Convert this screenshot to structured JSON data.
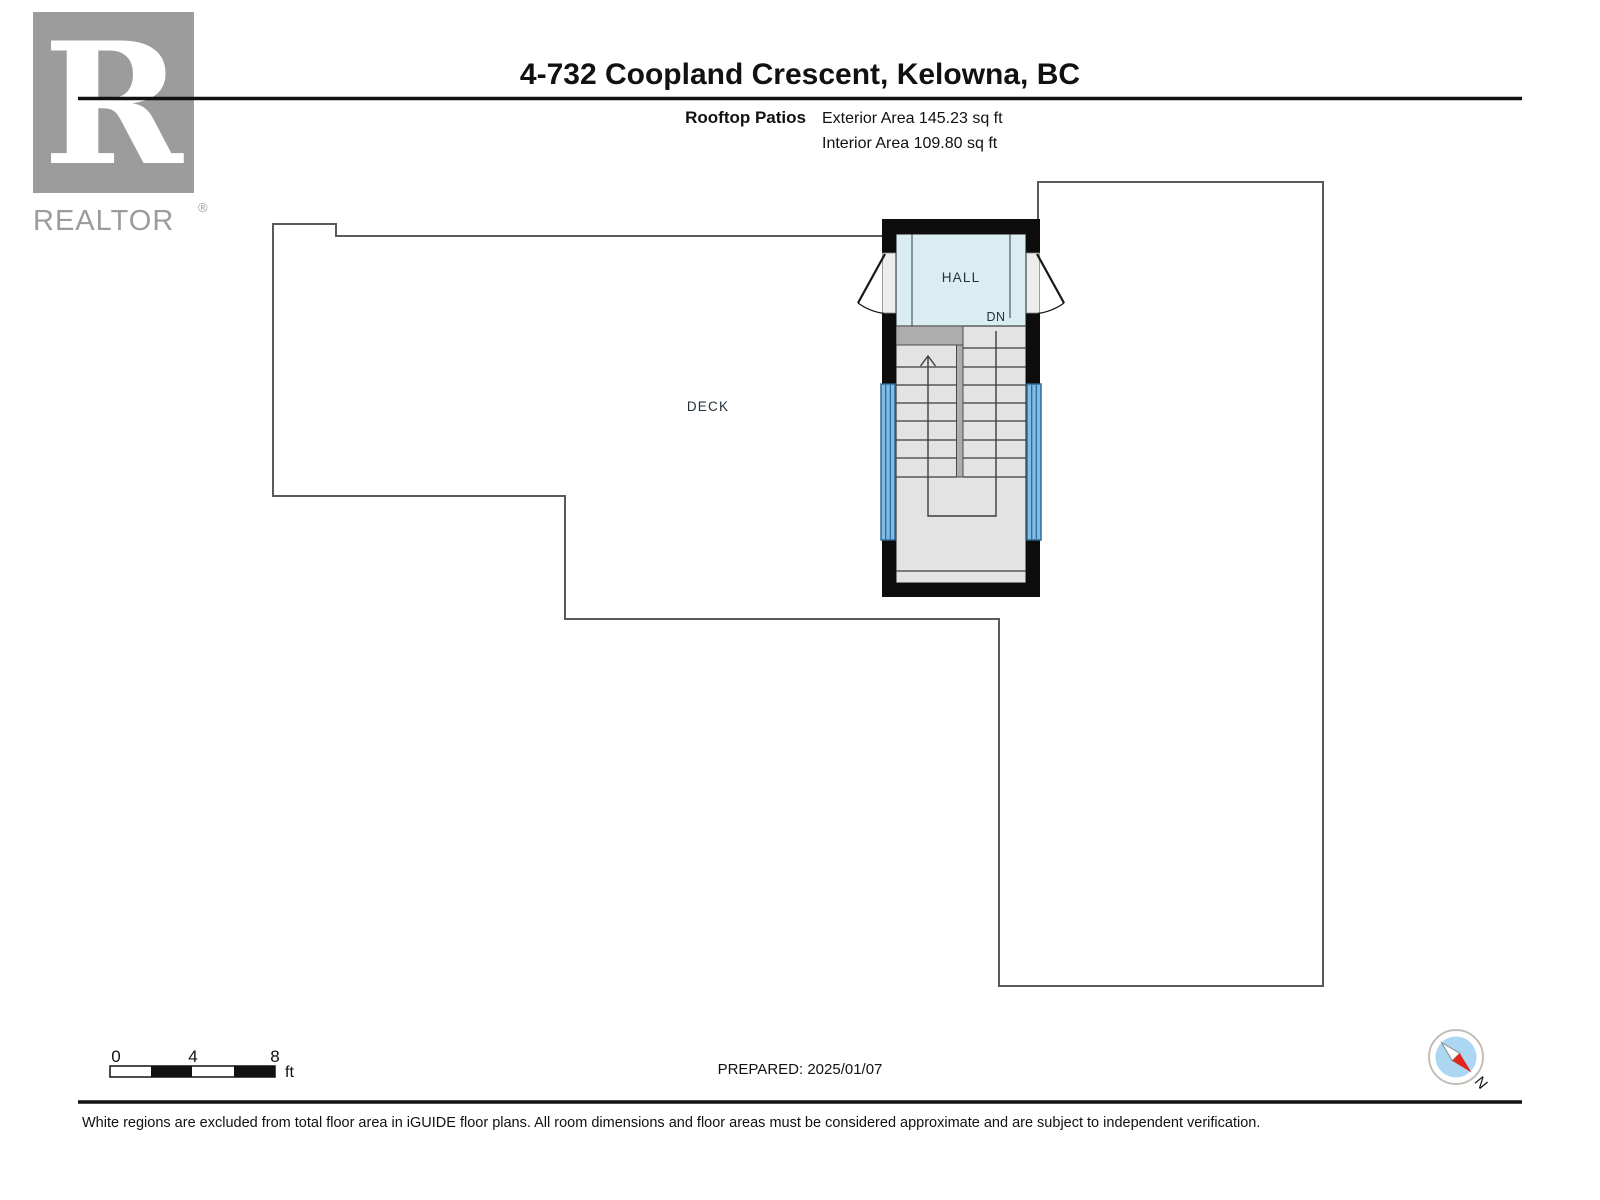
{
  "header": {
    "logo": {
      "letter": "R",
      "brand": "REALTOR",
      "registered": "®"
    },
    "title": "4-732 Coopland Crescent, Kelowna, BC",
    "floor_label": "Rooftop Patios",
    "exterior_area": "Exterior Area 145.23 sq ft",
    "interior_area": "Interior Area 109.80 sq ft"
  },
  "floorplan": {
    "deck_label": "DECK",
    "hall_label": "HALL",
    "stair_direction": "DN"
  },
  "footer": {
    "scale_bar": {
      "tick0": "0",
      "tick4": "4",
      "tick8": "8",
      "unit": "ft"
    },
    "prepared": "PREPARED: 2025/01/07",
    "compass_north": "N",
    "disclaimer": "White regions are excluded from total floor area in iGUIDE floor plans. All room dimensions and floor areas must be considered approximate and are subject to independent verification."
  },
  "colors": {
    "wall_black": "#0d0d0d",
    "outline_gray": "#5a5a5a",
    "hall_fill": "#d9edf2",
    "stair_fill": "#e3e3e3",
    "landing_gray": "#adadad",
    "window_fill": "#7fbde8",
    "window_frame": "#2a6390",
    "compass_disc": "#abd7f2",
    "compass_red": "#e2251d",
    "logo_gray": "#9c9c9c"
  }
}
